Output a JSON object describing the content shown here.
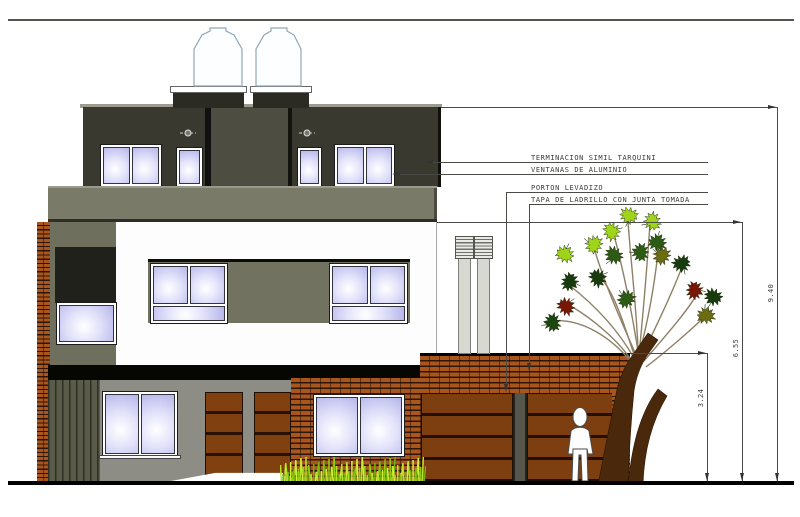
{
  "elevation": {
    "type": "architectural-front-elevation",
    "callouts": [
      {
        "id": "finish",
        "text": "TERMINACION SIMIL TARQUINI"
      },
      {
        "id": "windows",
        "text": "VENTANAS DE ALUMINIO"
      },
      {
        "id": "garage-door",
        "text": "PORTON LEVADIZO"
      },
      {
        "id": "brick-coping",
        "text": "TAPA DE LADRILLO CON JUNTA TOMADA"
      }
    ],
    "dimensions": [
      {
        "id": "total-height",
        "value": "9.40"
      },
      {
        "id": "mid-height",
        "value": "6.55"
      },
      {
        "id": "garage-height",
        "value": "3.24"
      }
    ],
    "colors": {
      "dark_wall": "#39392f",
      "tower_wall": "#4d4e41",
      "slab_band": "#797a67",
      "column_wall": "#6e6f5d",
      "gray_wall": "#8d8d85",
      "brick": "#a8561e",
      "door_wood": "#80400f",
      "glass": "#c9c9f0",
      "grass": "#a4dc1f",
      "leaf_light": "#9fd41a",
      "leaf_dark": "#2d5a14",
      "leaf_red": "#7a1606"
    },
    "objects": [
      "water-tanks",
      "chimneys",
      "tree",
      "person",
      "grass",
      "garage-doors",
      "windows",
      "brick-walls"
    ]
  }
}
